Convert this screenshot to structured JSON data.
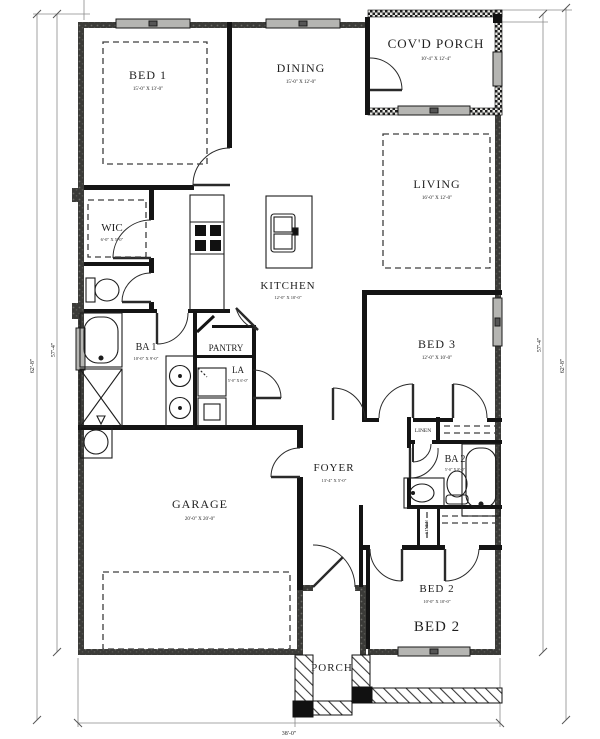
{
  "plan_title": "Single-story house floor plan",
  "rooms": {
    "bed1": {
      "name": "BED 1",
      "dims": "15'-0\" X 13'-0\""
    },
    "dining": {
      "name": "DINING",
      "dims": "15'-0\" X 12'-0\""
    },
    "covd_porch": {
      "name": "COV'D PORCH",
      "dims": "10'-4\" X 12'-4\""
    },
    "living": {
      "name": "LIVING",
      "dims": "16'-0\" X 12'-0\""
    },
    "wic": {
      "name": "WIC",
      "dims": "6'-0\" X 5'-0\""
    },
    "kitchen": {
      "name": "KITCHEN",
      "dims": "12'-0\" X 10'-0\""
    },
    "ba1": {
      "name": "BA 1",
      "dims": "10'-0\" X 9'-0\""
    },
    "pantry": {
      "name": "PANTRY"
    },
    "la": {
      "name": "LA",
      "dims": "5'-0\" X 6'-0\""
    },
    "bed3": {
      "name": "BED 3",
      "dims": "12'-0\" X 10'-0\""
    },
    "foyer": {
      "name": "FOYER",
      "dims": "13'-4\" X 5'-0\""
    },
    "linen": {
      "name": "LINEN"
    },
    "hall_closet": {
      "name": "LINEN"
    },
    "ba2": {
      "name": "BA 2",
      "dims": "5'-0\" X 8'-0\""
    },
    "garage": {
      "name": "GARAGE",
      "dims": "20'-0\" X 20'-0\""
    },
    "bed2": {
      "name": "BED 2",
      "dims": "10'-0\" X 10'-0\"",
      "label_large": "BED 2"
    },
    "porch": {
      "name": "PORCH"
    }
  },
  "dimensions": {
    "left_outer": "62'-8\"",
    "left_inner": "57'-4\"",
    "right_inner": "57'-4\"",
    "right_outer": "62'-8\"",
    "bottom": "38'-0\""
  },
  "colors": {
    "wall": "#141414",
    "window_fill": "#b5b5b2",
    "dim_line": "#8a8a8a",
    "paper": "#ffffff"
  }
}
